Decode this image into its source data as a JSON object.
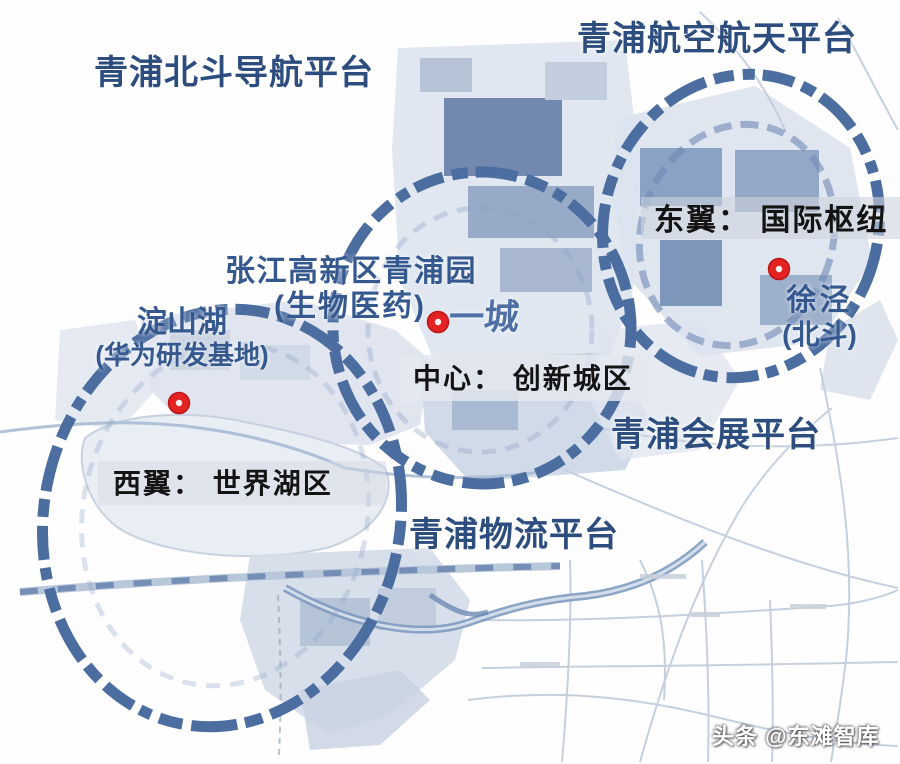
{
  "platforms": {
    "beidou": "青浦北斗导航平台",
    "aerospace": "青浦航空航天平台",
    "exhibition": "青浦会展平台",
    "logistics": "青浦物流平台"
  },
  "zones": {
    "east_wing": "东翼： 国际枢纽",
    "center": "中心： 创新城区",
    "west_wing": "西翼： 世界湖区"
  },
  "pois": {
    "zhangjiang_line1": "张江高新区青浦园",
    "zhangjiang_line2": "(生物医药)",
    "yicheng": "一城",
    "dianshanhu_line1": "淀山湖",
    "dianshanhu_line2": "(华为研发基地)",
    "xujing_line1": "徐泾",
    "xujing_line2": "(北斗)"
  },
  "markers": [
    {
      "name": "dianshanhu-marker",
      "color": "#e32222"
    },
    {
      "name": "yicheng-marker",
      "color": "#e32222"
    },
    {
      "name": "xujing-marker",
      "color": "#e32222"
    }
  ],
  "watermark": "头条 @东滩智库",
  "colors": {
    "platform_label": "#2d4d7f",
    "poi_label": "#35588e",
    "zone_label": "#141414",
    "ring_dash": "#4b6da0",
    "marker_red": "#e32222",
    "map_fabric_light": "#dde4ef",
    "map_block_dark": "#7288ae",
    "map_block_medium": "#8ba3c4",
    "river": "#7f9ac0",
    "road": "#c3cede",
    "watermark_text": "#ffffff"
  }
}
